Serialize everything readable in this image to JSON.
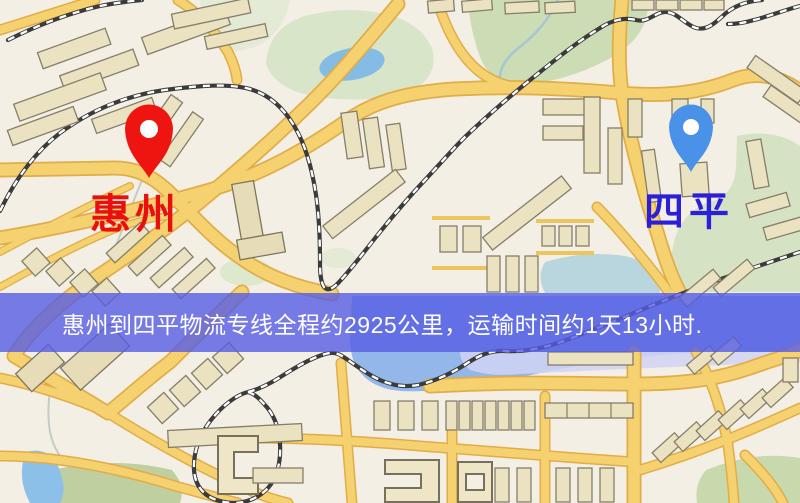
{
  "banner": {
    "text": "惠州到四平物流专线全程约2925公里，运输时间约1天13小时.",
    "background": "#565CE4",
    "text_color": "#ffffff"
  },
  "markers": {
    "origin": {
      "label": "惠州",
      "label_color": "#e90f0f",
      "pin_color": "#ee1511",
      "pin_icon": "red-map-pin-icon"
    },
    "destination": {
      "label": "四平",
      "label_color": "#2b1fd8",
      "pin_color": "#4a91e8",
      "pin_icon": "blue-map-pin-icon"
    }
  },
  "map": {
    "palette": {
      "background": "#f4efe5",
      "road_fill": "#f6d170",
      "road_casing": "#e0ad48",
      "building": "#ebe2c2",
      "building_outline": "#857e68",
      "park": "#d6e2c4",
      "water": "#92b7e8",
      "railway": "#3b3b3b"
    }
  }
}
